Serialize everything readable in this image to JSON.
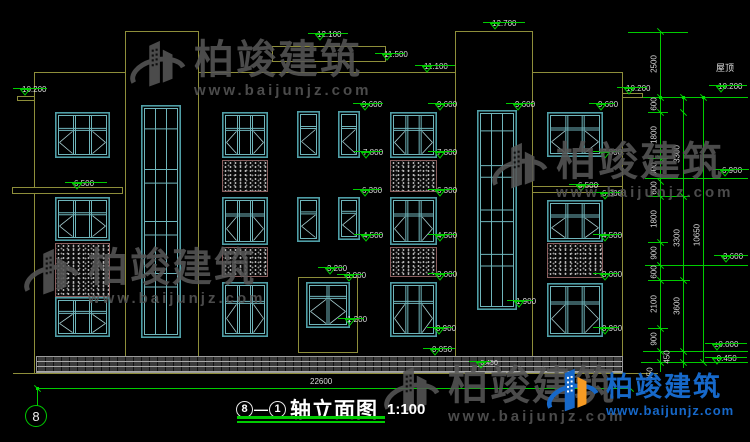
{
  "meta": {
    "bg": "#000000",
    "line_yellow": "#8e8e3a",
    "dim_green": "#00cc00",
    "window_teal": "#4f9ea6",
    "logo_blue": "#1668c9",
    "logo_orange": "#f59a23",
    "watermark_gray": "#565656"
  },
  "title": {
    "axis_start": "8",
    "separator": "—",
    "axis_end": "1",
    "name": "轴立面图",
    "scale": "1:100"
  },
  "axis_bubble": "8",
  "bottom_dim": "22600",
  "roof_label": "屋顶",
  "watermark": {
    "name": "柏竣建筑",
    "url": "www.baijunjz.com"
  },
  "logo": {
    "name": "柏竣建筑",
    "url": "www.baijunjz.com"
  },
  "level_markers": [
    {
      "v": "10.200",
      "x": 12,
      "y": 79,
      "w": 34
    },
    {
      "v": "6.500",
      "x": 64,
      "y": 173,
      "w": 42
    },
    {
      "v": "12.100",
      "x": 307,
      "y": 24,
      "w": 40
    },
    {
      "v": "11.500",
      "x": 374,
      "y": 44,
      "w": 30
    },
    {
      "v": "11.100",
      "x": 414,
      "y": 56,
      "w": 40
    },
    {
      "v": "12.700",
      "x": 482,
      "y": 13,
      "w": 42
    },
    {
      "v": "10.200",
      "x": 616,
      "y": 78,
      "w": 30
    },
    {
      "v": "9.600",
      "x": 352,
      "y": 94,
      "w": 30
    },
    {
      "v": "9.600",
      "x": 427,
      "y": 94,
      "w": 28
    },
    {
      "v": "9.600",
      "x": 505,
      "y": 94,
      "w": 28
    },
    {
      "v": "9.600",
      "x": 588,
      "y": 94,
      "w": 26
    },
    {
      "v": "7.800",
      "x": 353,
      "y": 142,
      "w": 28
    },
    {
      "v": "7.800",
      "x": 427,
      "y": 142,
      "w": 28
    },
    {
      "v": "7.800",
      "x": 592,
      "y": 142,
      "w": 28
    },
    {
      "v": "6.300",
      "x": 352,
      "y": 180,
      "w": 28
    },
    {
      "v": "6.300",
      "x": 427,
      "y": 180,
      "w": 28
    },
    {
      "v": "6.300",
      "x": 592,
      "y": 183,
      "w": 28
    },
    {
      "v": "6.500",
      "x": 568,
      "y": 175,
      "w": 30
    },
    {
      "v": "6.900",
      "x": 712,
      "y": 160,
      "w": 36
    },
    {
      "v": "4.500",
      "x": 353,
      "y": 225,
      "w": 28
    },
    {
      "v": "4.500",
      "x": 427,
      "y": 225,
      "w": 28
    },
    {
      "v": "4.500",
      "x": 592,
      "y": 225,
      "w": 28
    },
    {
      "v": "3.200",
      "x": 317,
      "y": 258,
      "w": 26
    },
    {
      "v": "3.000",
      "x": 336,
      "y": 265,
      "w": 26
    },
    {
      "v": "3.000",
      "x": 427,
      "y": 264,
      "w": 26
    },
    {
      "v": "3.000",
      "x": 592,
      "y": 264,
      "w": 26
    },
    {
      "v": "1.900",
      "x": 506,
      "y": 291,
      "w": 26
    },
    {
      "v": "1.200",
      "x": 337,
      "y": 309,
      "w": 26
    },
    {
      "v": "0.900",
      "x": 426,
      "y": 318,
      "w": 26
    },
    {
      "v": "0.900",
      "x": 592,
      "y": 318,
      "w": 26
    },
    {
      "v": "0.050",
      "x": 422,
      "y": 339,
      "w": 32
    },
    {
      "v": "-0.450",
      "x": 468,
      "y": 352,
      "w": 22,
      "s": 1
    },
    {
      "v": "10.200",
      "x": 708,
      "y": 76,
      "w": 38
    },
    {
      "v": "3.600",
      "x": 713,
      "y": 246,
      "w": 34
    },
    {
      "v": "±0.000",
      "x": 704,
      "y": 334,
      "w": 42
    },
    {
      "v": "-0.450",
      "x": 704,
      "y": 348,
      "w": 42
    }
  ],
  "chain_labels": [
    {
      "v": "2500",
      "x": 654,
      "y": 64
    },
    {
      "v": "600",
      "x": 654,
      "y": 104
    },
    {
      "v": "1800",
      "x": 654,
      "y": 135
    },
    {
      "v": "900",
      "x": 654,
      "y": 169
    },
    {
      "v": "600",
      "x": 654,
      "y": 188
    },
    {
      "v": "1800",
      "x": 654,
      "y": 219
    },
    {
      "v": "900",
      "x": 654,
      "y": 253
    },
    {
      "v": "600",
      "x": 654,
      "y": 272
    },
    {
      "v": "2100",
      "x": 654,
      "y": 304
    },
    {
      "v": "900",
      "x": 654,
      "y": 339
    },
    {
      "v": "450",
      "x": 667,
      "y": 357
    },
    {
      "v": "450",
      "x": 650,
      "y": 374
    },
    {
      "v": "3300",
      "x": 677,
      "y": 154
    },
    {
      "v": "3300",
      "x": 677,
      "y": 238
    },
    {
      "v": "3600",
      "x": 677,
      "y": 306
    },
    {
      "v": "10650",
      "x": 697,
      "y": 235
    }
  ],
  "windows": [
    {
      "t": "w3",
      "x": 55,
      "y": 112,
      "w": 55,
      "h": 46
    },
    {
      "t": "w3",
      "x": 55,
      "y": 197,
      "w": 55,
      "h": 44
    },
    {
      "t": "w3",
      "x": 55,
      "y": 297,
      "w": 55,
      "h": 40
    },
    {
      "t": "tall",
      "x": 141,
      "y": 105,
      "w": 40,
      "h": 233
    },
    {
      "t": "w3",
      "x": 222,
      "y": 112,
      "w": 46,
      "h": 46
    },
    {
      "t": "w3",
      "x": 222,
      "y": 197,
      "w": 46,
      "h": 48
    },
    {
      "t": "w3",
      "x": 222,
      "y": 282,
      "w": 46,
      "h": 55
    },
    {
      "t": "w2",
      "x": 297,
      "y": 111,
      "w": 23,
      "h": 47
    },
    {
      "t": "w2",
      "x": 297,
      "y": 197,
      "w": 23,
      "h": 45
    },
    {
      "t": "w2",
      "x": 338,
      "y": 111,
      "w": 22,
      "h": 47
    },
    {
      "t": "w2",
      "x": 338,
      "y": 197,
      "w": 22,
      "h": 43
    },
    {
      "t": "w3",
      "x": 390,
      "y": 112,
      "w": 47,
      "h": 46
    },
    {
      "t": "w3",
      "x": 390,
      "y": 197,
      "w": 47,
      "h": 48
    },
    {
      "t": "w3",
      "x": 390,
      "y": 282,
      "w": 47,
      "h": 55
    },
    {
      "t": "tall",
      "x": 477,
      "y": 110,
      "w": 40,
      "h": 200
    },
    {
      "t": "w3",
      "x": 547,
      "y": 112,
      "w": 56,
      "h": 45
    },
    {
      "t": "w3",
      "x": 547,
      "y": 200,
      "w": 56,
      "h": 42
    },
    {
      "t": "w3",
      "x": 547,
      "y": 283,
      "w": 56,
      "h": 54
    },
    {
      "t": "door",
      "x": 306,
      "y": 282,
      "w": 44,
      "h": 46
    }
  ],
  "drawing": {
    "yellow_v": [
      [
        34,
        72,
        373
      ],
      [
        125,
        31,
        373
      ],
      [
        198,
        31,
        373
      ],
      [
        455,
        31,
        373
      ],
      [
        532,
        31,
        373
      ],
      [
        622,
        72,
        373
      ]
    ],
    "yellow_h": [
      [
        34,
        72,
        125
      ],
      [
        198,
        72,
        455
      ],
      [
        532,
        72,
        622
      ],
      [
        125,
        31,
        198
      ],
      [
        455,
        31,
        532
      ],
      [
        13,
        373,
        658
      ]
    ],
    "rects": [
      [
        17,
        96,
        18,
        5
      ],
      [
        622,
        93,
        21,
        5
      ],
      [
        272,
        46,
        114,
        16
      ],
      [
        12,
        187,
        111,
        7
      ],
      [
        532,
        186,
        91,
        7
      ],
      [
        298,
        277,
        60,
        76
      ]
    ],
    "base": [
      36,
      356,
      587,
      17
    ],
    "speckles": [
      [
        55,
        243,
        55,
        54
      ],
      [
        222,
        160,
        46,
        32
      ],
      [
        222,
        247,
        46,
        30
      ],
      [
        390,
        160,
        47,
        32
      ],
      [
        390,
        247,
        47,
        30
      ],
      [
        547,
        243,
        56,
        35
      ]
    ],
    "green_v": [
      [
        660,
        31,
        372
      ],
      [
        683,
        97,
        368
      ],
      [
        703,
        97,
        363
      ],
      [
        37,
        389,
        406
      ]
    ],
    "green_h": [
      [
        628,
        32,
        688
      ],
      [
        643,
        97,
        748
      ],
      [
        648,
        112,
        668
      ],
      [
        648,
        158,
        668
      ],
      [
        645,
        178,
        748
      ],
      [
        648,
        196,
        690
      ],
      [
        648,
        242,
        668
      ],
      [
        645,
        265,
        748
      ],
      [
        648,
        280,
        690
      ],
      [
        648,
        328,
        668
      ],
      [
        643,
        351,
        748
      ],
      [
        641,
        362,
        748
      ],
      [
        37,
        388,
        630
      ]
    ],
    "ticks": [
      [
        660,
        31
      ],
      [
        660,
        97
      ],
      [
        660,
        112
      ],
      [
        660,
        158
      ],
      [
        660,
        181
      ],
      [
        660,
        196
      ],
      [
        660,
        242
      ],
      [
        660,
        265
      ],
      [
        660,
        280
      ],
      [
        660,
        328
      ],
      [
        660,
        351
      ],
      [
        660,
        362
      ],
      [
        683,
        97
      ],
      [
        683,
        112
      ],
      [
        683,
        196
      ],
      [
        683,
        280
      ],
      [
        683,
        351
      ],
      [
        683,
        362
      ],
      [
        703,
        97
      ],
      [
        703,
        362
      ],
      [
        37,
        388
      ],
      [
        630,
        388
      ]
    ],
    "dots": [
      [
        36,
        387
      ],
      [
        659,
        96
      ],
      [
        682,
        96
      ],
      [
        702,
        96
      ]
    ],
    "watermarks": [
      {
        "x": 126,
        "y": 38
      },
      {
        "x": 488,
        "y": 140
      },
      {
        "x": 20,
        "y": 246
      },
      {
        "x": 380,
        "y": 364
      }
    ]
  }
}
